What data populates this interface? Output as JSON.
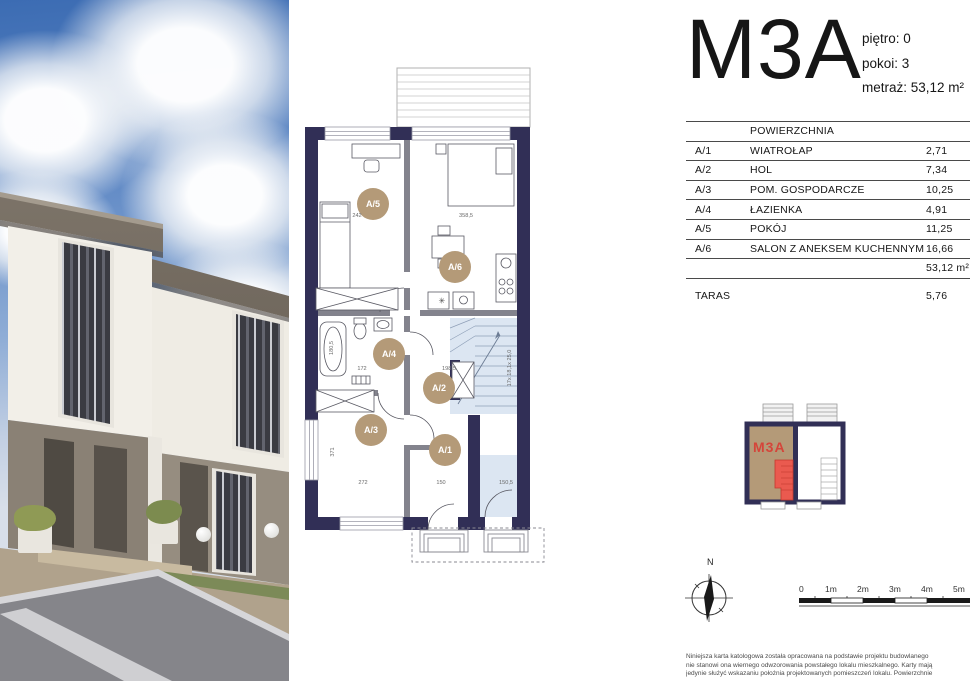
{
  "unit": {
    "name": "M3A",
    "floor_label": "piętro: 0",
    "rooms_label": "pokoi: 3",
    "area_label": "metraż: 53,12 m²"
  },
  "table": {
    "header": "POWIERZCHNIA",
    "rows": [
      {
        "code": "A/1",
        "name": "WIATROŁAP",
        "area": "2,71"
      },
      {
        "code": "A/2",
        "name": "HOL",
        "area": "7,34"
      },
      {
        "code": "A/3",
        "name": "POM. GOSPODARCZE",
        "area": "10,25"
      },
      {
        "code": "A/4",
        "name": "ŁAZIENKA",
        "area": "4,91"
      },
      {
        "code": "A/5",
        "name": "POKÓJ",
        "area": "11,25"
      },
      {
        "code": "A/6",
        "name": "SALON Z ANEKSEM KUCHENNYM",
        "area": "16,66"
      }
    ],
    "total": "53,12 m²",
    "taras_label": "TARAS",
    "taras_value": "5,76"
  },
  "plan": {
    "room_badges": [
      {
        "id": "A/5",
        "x": 73,
        "y": 144
      },
      {
        "id": "A/6",
        "x": 155,
        "y": 207
      },
      {
        "id": "A/4",
        "x": 89,
        "y": 294
      },
      {
        "id": "A/2",
        "x": 139,
        "y": 328
      },
      {
        "id": "A/3",
        "x": 71,
        "y": 370
      },
      {
        "id": "A/1",
        "x": 145,
        "y": 390
      }
    ],
    "dimensions": [
      {
        "t": "242",
        "x": 57,
        "y": 157,
        "r": 0
      },
      {
        "t": "358,5",
        "x": 166,
        "y": 157,
        "r": 0
      },
      {
        "t": "180,5",
        "x": 33,
        "y": 288,
        "r": -90
      },
      {
        "t": "172",
        "x": 62,
        "y": 310,
        "r": 0
      },
      {
        "t": "198,5",
        "x": 149,
        "y": 310,
        "r": 0
      },
      {
        "t": "371",
        "x": 34,
        "y": 392,
        "r": -90
      },
      {
        "t": "272",
        "x": 63,
        "y": 424,
        "r": 0
      },
      {
        "t": "150",
        "x": 141,
        "y": 424,
        "r": 0
      },
      {
        "t": "150,5",
        "x": 206,
        "y": 424,
        "r": 0
      },
      {
        "t": "17x 18,1x 25,0",
        "x": 211,
        "y": 308,
        "r": -90
      }
    ],
    "colors": {
      "wall": "#312f56",
      "badge": "#b49a78",
      "stairs": "#dce6f2",
      "partition": "#83838d"
    }
  },
  "minimap": {
    "label": "M3A",
    "label_color": "#d5453a",
    "unit_fill": "#b49a78",
    "stair_fill": "#ea5a4f"
  },
  "compass": {
    "north_label": "N"
  },
  "scalebar": {
    "labels": [
      "0",
      "1m",
      "2m",
      "3m",
      "4m",
      "5m"
    ]
  },
  "disclaimer": {
    "lines": [
      "Niniejsza karta katologowa została opracowana na podstawie projektu budowlanego",
      "nie stanowi ona wiernego odwzorowania powstałego lokalu mieszkalnego. Karty mają",
      "jedynie służyć wskazaniu położnia projektowanych pomieszczeń lokalu. Powierzchnie"
    ]
  }
}
